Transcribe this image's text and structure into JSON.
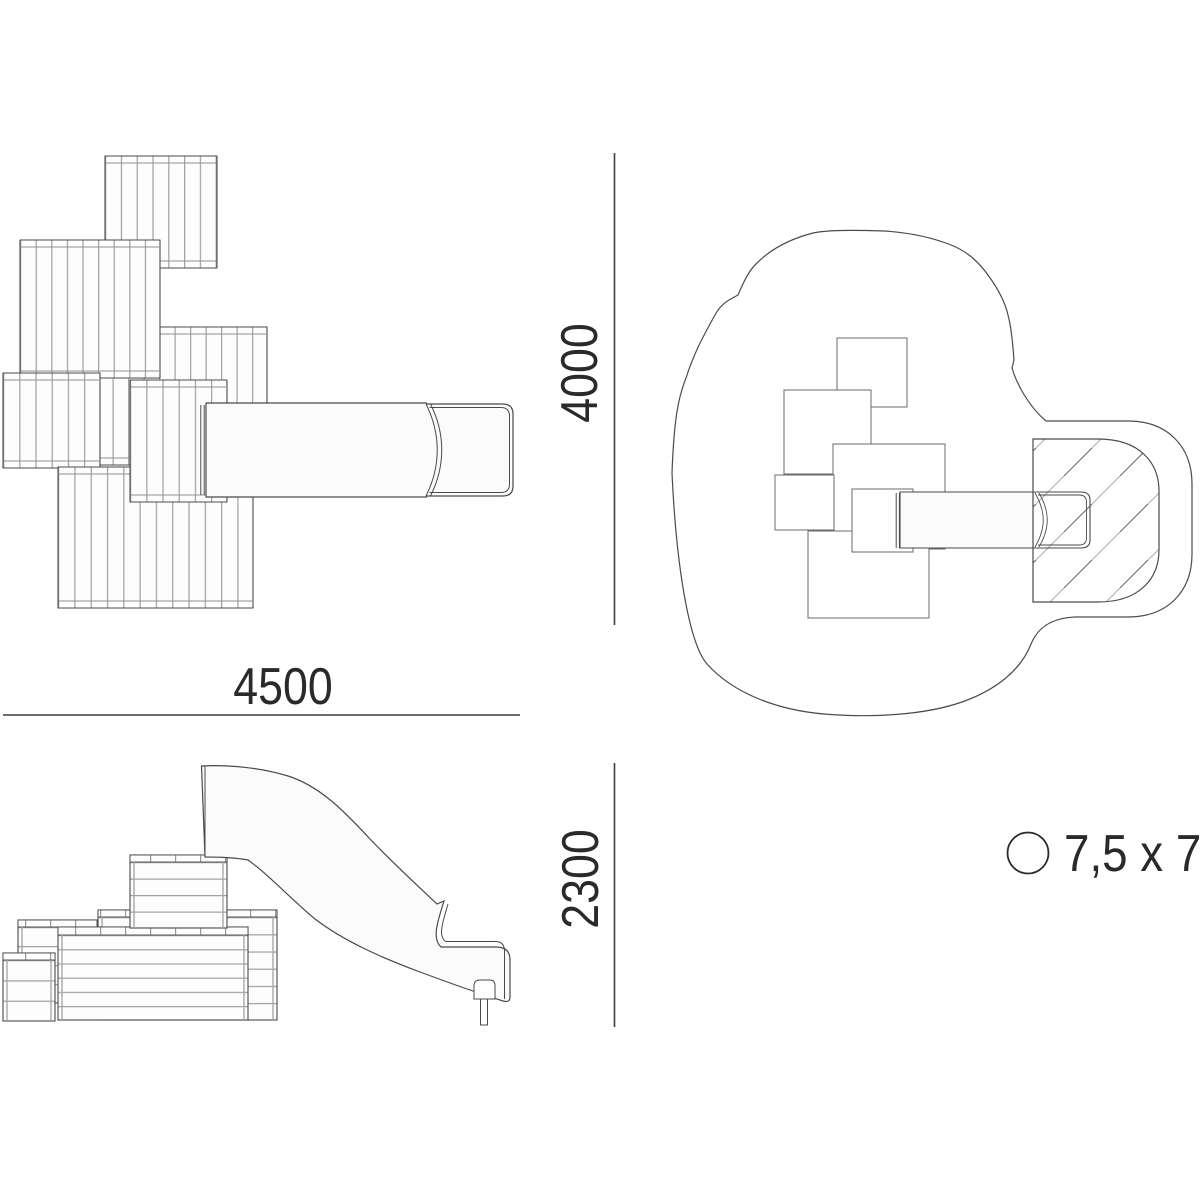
{
  "dimensions": {
    "plan_width_mm": "4500",
    "plan_depth_mm": "4000",
    "elevation_height_mm": "2300"
  },
  "legend": {
    "safety_area_size": "7,5 x 7"
  },
  "colors": {
    "background": "#ffffff",
    "outline": "#4b4a48",
    "dimension_line": "#3f3e3c",
    "dimension_text": "#2b2a29",
    "slat_gap": "#a3a3a1",
    "surface_fill": "#fbfbfb",
    "hatch_dark": "#6a6a68",
    "hatch_light": "#a8a8a6"
  }
}
